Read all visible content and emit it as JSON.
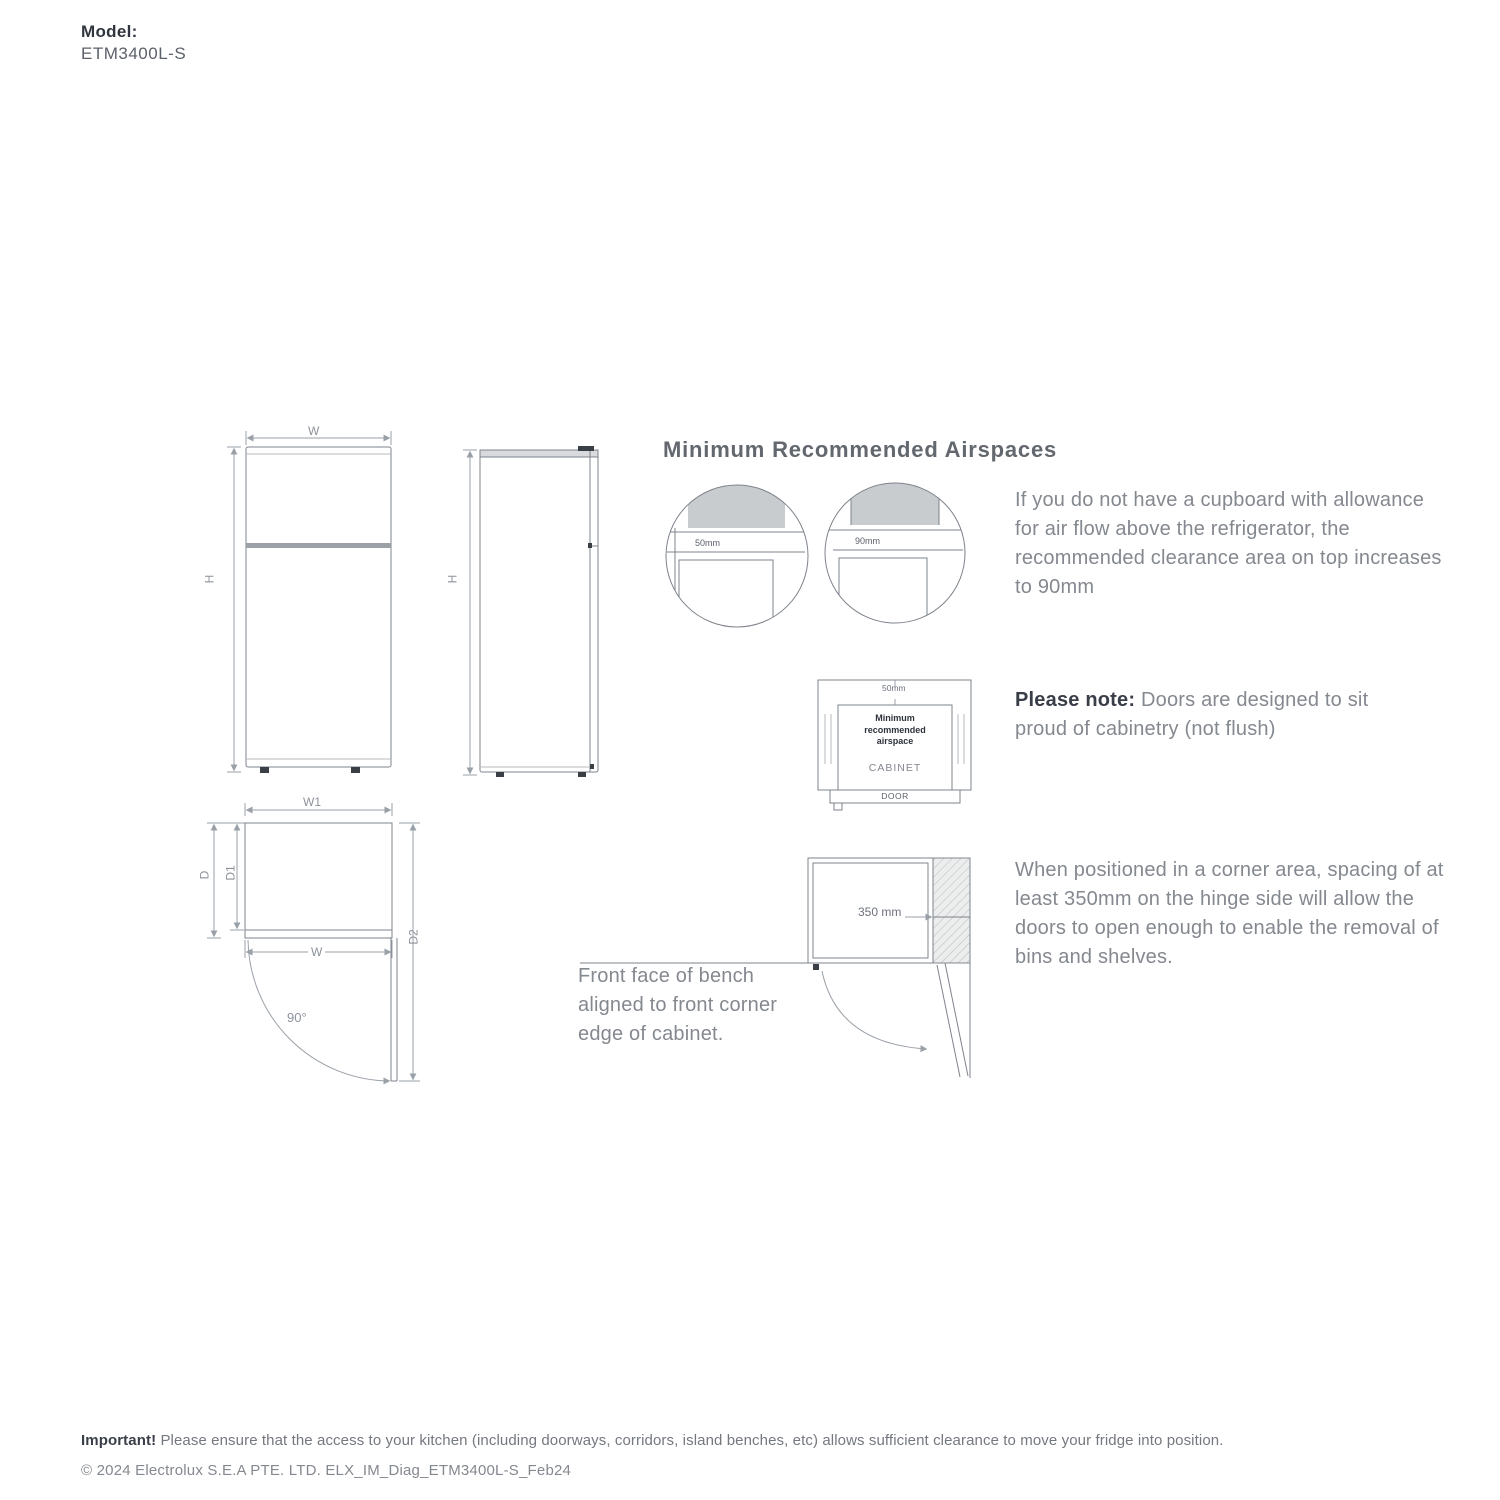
{
  "model": {
    "label": "Model:",
    "value": "ETM3400L-S"
  },
  "airspaces": {
    "heading": "Minimum Recommended Airspaces",
    "circle_left_gap": "50mm",
    "circle_right_gap": "90mm",
    "note_cupboard": "If you do not have a cupboard with allowance for air flow above the refrigerator, the recommended clearance area on top increases to 90mm",
    "cabinet": {
      "top_gap": "50mm",
      "airspace_note": "Minimum recommended airspace",
      "cabinet_label": "CABINET",
      "door_label": "DOOR"
    },
    "please_note_bold": "Please note:",
    "please_note_rest": " Doors are designed to sit proud of cabinetry (not flush)"
  },
  "dims": {
    "front_width": "W",
    "front_height": "H",
    "side_height": "H",
    "top_width_overall": "W1",
    "top_depth": "D",
    "top_depth_body": "D1",
    "top_door_width": "W",
    "top_depth_open": "D2",
    "door_angle": "90°"
  },
  "corner": {
    "spacing": "350 mm",
    "bench_note": "Front face of bench aligned to front corner edge of cabinet.",
    "note": "When positioned in a corner area, spacing of at least 350mm on the hinge side will allow the doors to open enough to enable the removal of bins and shelves."
  },
  "footer": {
    "important_bold": "Important!",
    "important_rest": " Please ensure that the access to your kitchen (including doorways, corridors, island benches, etc) allows sufficient clearance to move your fridge into position.",
    "copyright": "© 2024 Electrolux S.E.A PTE. LTD. ELX_IM_Diag_ETM3400L-S_Feb24"
  },
  "colors": {
    "text_dark": "#3c404b",
    "text_gray": "#84888f",
    "line": "#8a8f96",
    "fill_gray": "#c9cccf"
  }
}
